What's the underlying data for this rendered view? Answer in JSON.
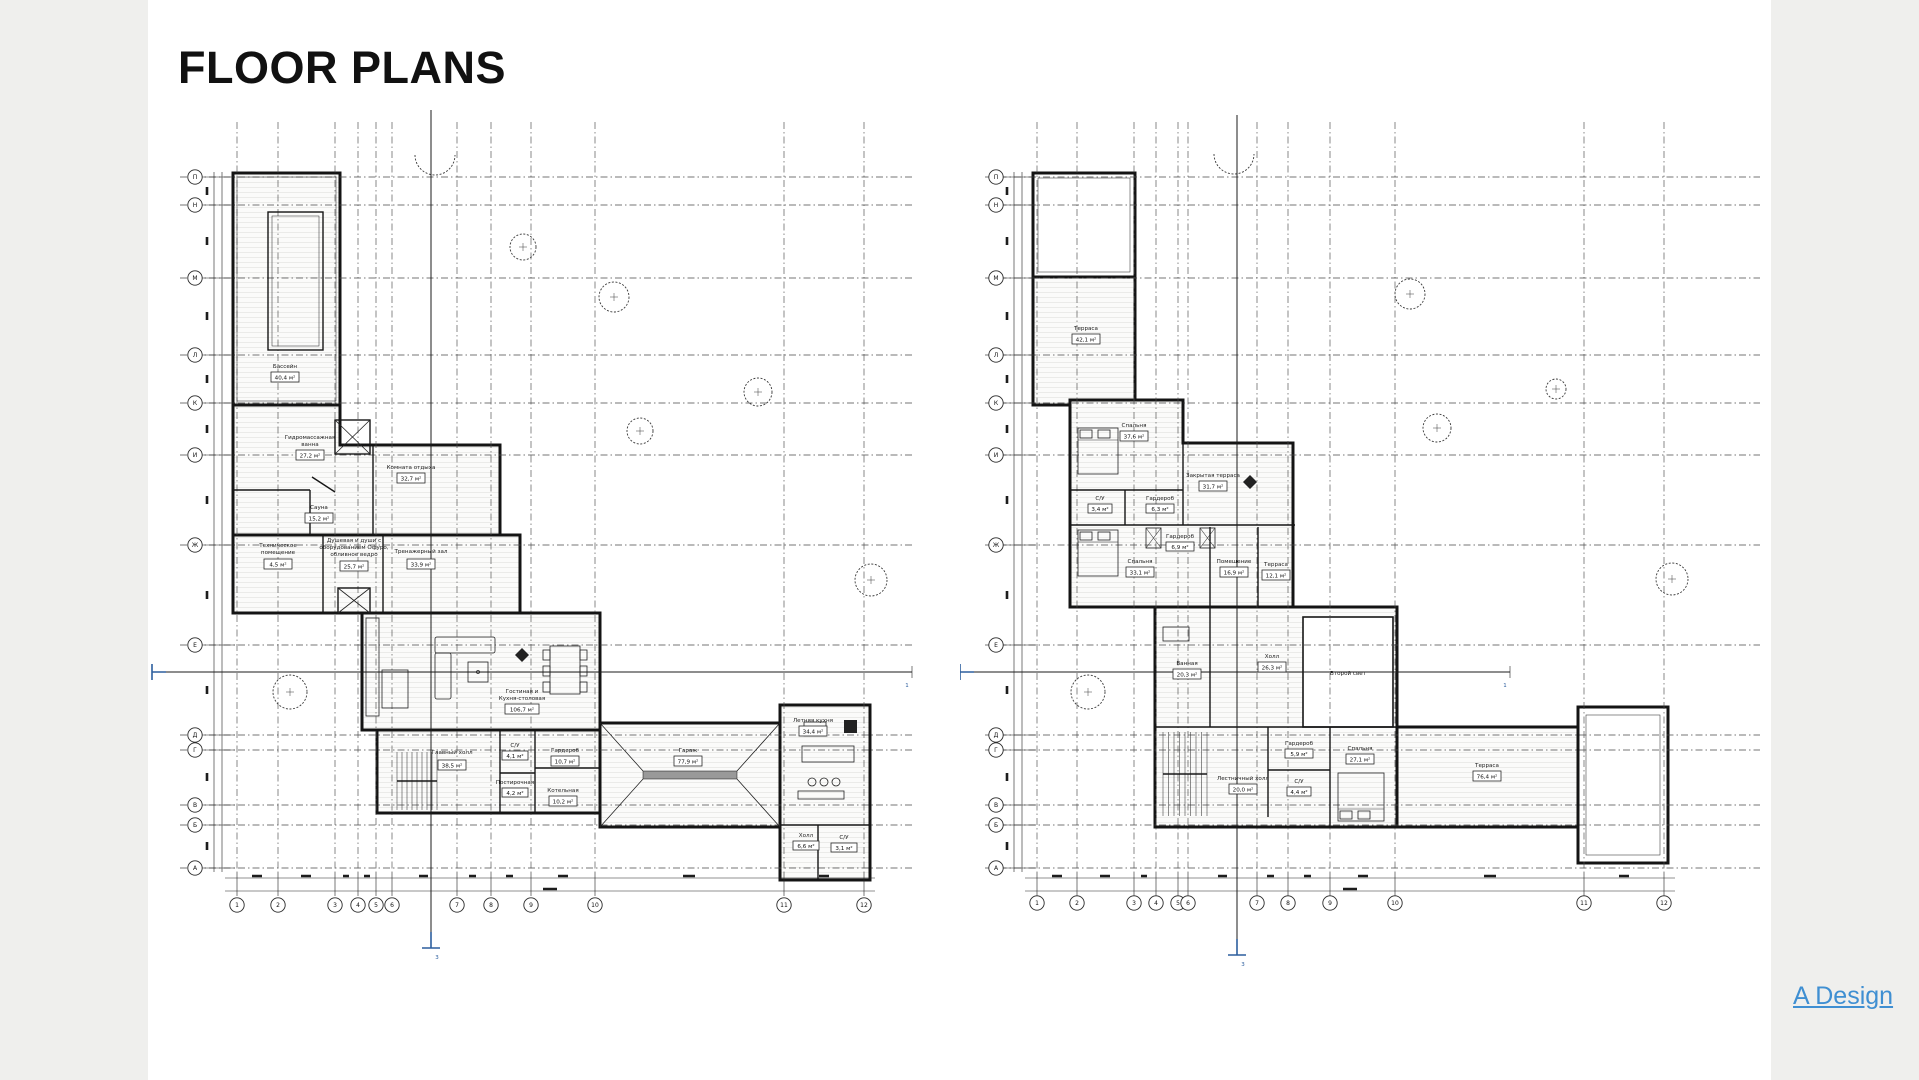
{
  "colors": {
    "background": "#efefed",
    "paper": "#ffffff",
    "walls": "#141414",
    "link_blue": "#3f8fd2",
    "section_blue": "#2d5f9e"
  },
  "header": {
    "title": "FLOOR PLANS"
  },
  "credit_link": {
    "text": "A Design"
  },
  "grid": {
    "rows": [
      "П",
      "Н",
      "М",
      "Л",
      "К",
      "И",
      "Ж",
      "Е",
      "Д",
      "Г",
      "В",
      "Б",
      "А"
    ],
    "cols": [
      "1",
      "2",
      "3",
      "4",
      "5",
      "6",
      "7",
      "8",
      "9",
      "10",
      "11",
      "12"
    ]
  },
  "plans": [
    {
      "name": "first-floor-plan",
      "section_labels": {
        "bottom": "3",
        "side": "1"
      },
      "rooms": [
        {
          "name": "Бассейн",
          "area": "40,4 м²"
        },
        {
          "name": "Гидромассажная",
          "name2": "ванна",
          "area": "27,2 м²"
        },
        {
          "name": "Сауна",
          "area": "15,2 м²"
        },
        {
          "name": "Комната отдыха",
          "area": "32,7 м²"
        },
        {
          "name": "Техническое",
          "name2": "помещение",
          "area": "4,5 м²"
        },
        {
          "name": "Душевая и души с",
          "name2": "оборудованием Офуро,",
          "name3": "обливное ведро",
          "area": "25,7 м²"
        },
        {
          "name": "Тренажерный зал",
          "area": "33,9 м²"
        },
        {
          "name": "Гостиная и",
          "name2": "Кухня-столовая",
          "area": "106,7 м²"
        },
        {
          "name": "Главный холл",
          "area": "38,5 м²"
        },
        {
          "name": "С/У",
          "area": "4,1 м²"
        },
        {
          "name": "Постирочная",
          "area": "4,2 м²"
        },
        {
          "name": "Гардероб",
          "area": "10,7 м²"
        },
        {
          "name": "Котельная",
          "area": "10,2 м²"
        },
        {
          "name": "Гараж",
          "area": "77,9 м²"
        },
        {
          "name": "Летняя кухня",
          "area": "34,4 м²"
        },
        {
          "name": "Холл",
          "area": "6,6 м²"
        },
        {
          "name": "С/У",
          "area": "3,1 м²"
        }
      ]
    },
    {
      "name": "second-floor-plan",
      "section_labels": {
        "bottom": "3",
        "side": "1"
      },
      "rooms": [
        {
          "name": "Терраса",
          "area": "42,1 м²"
        },
        {
          "name": "Спальня",
          "area": "37,6 м²"
        },
        {
          "name": "С/У",
          "area": "3,4 м²"
        },
        {
          "name": "Гардероб",
          "area": "6,3 м²"
        },
        {
          "name": "Закрытая терраса",
          "area": "31,7 м²"
        },
        {
          "name": "Гардероб",
          "area": "6,9 м²"
        },
        {
          "name": "Спальня",
          "area": "33,1 м²"
        },
        {
          "name": "Помещение",
          "area": "16,9 м²"
        },
        {
          "name": "Терраса",
          "area": "12,1 м²"
        },
        {
          "name": "Ванная",
          "area": "20,3 м²"
        },
        {
          "name": "Холл",
          "area": "26,3 м²"
        },
        {
          "name": "Второй свет",
          "area": ""
        },
        {
          "name": "Лестничный холл",
          "area": "20,0 м²"
        },
        {
          "name": "Гардероб",
          "area": "5,9 м²"
        },
        {
          "name": "С/У",
          "area": "4,4 м²"
        },
        {
          "name": "Спальня",
          "area": "27,1 м²"
        },
        {
          "name": "Терраса",
          "area": "76,4 м²"
        }
      ]
    }
  ]
}
